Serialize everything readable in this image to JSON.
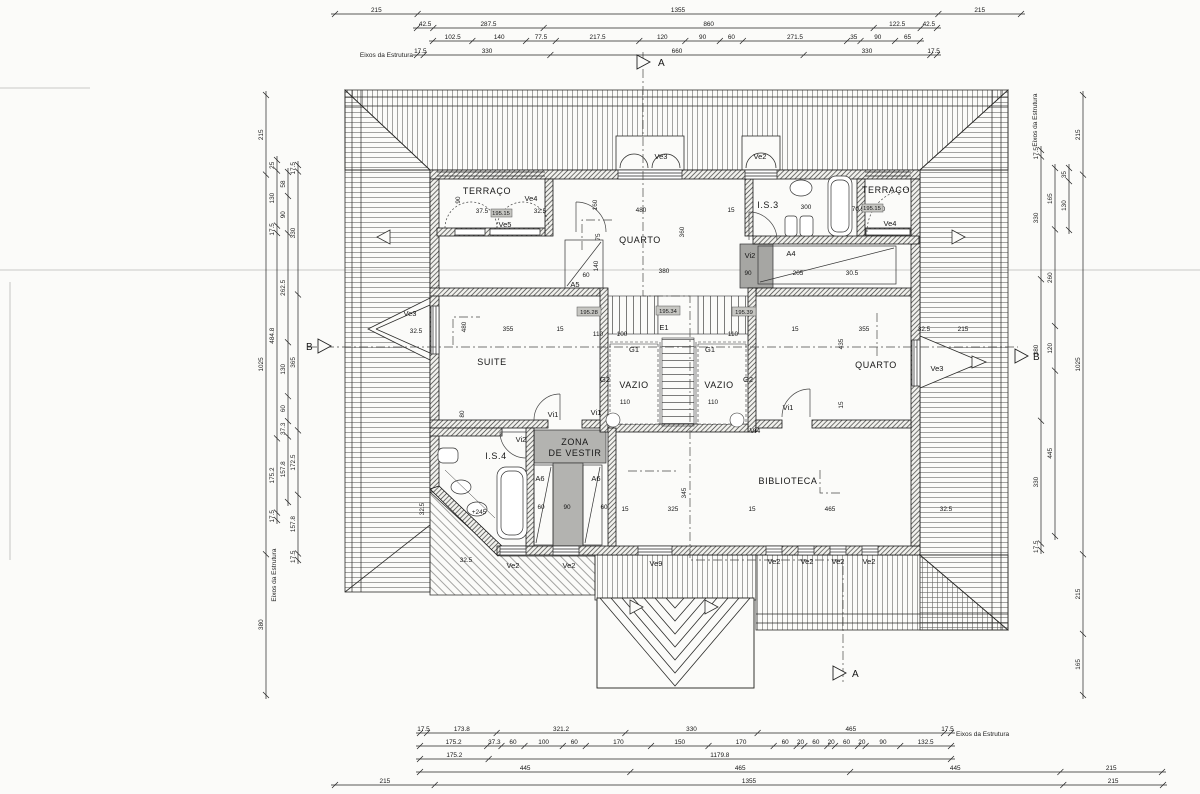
{
  "axis_label": "Eixos da Estrutura",
  "rooms": {
    "terraco_left": "TERRAÇO",
    "terraco_right": "TERRAÇO",
    "quarto_top": "QUARTO",
    "quarto_right": "QUARTO",
    "is3": "I.S.3",
    "is4": "I.S.4",
    "suite": "SUITE",
    "vazio_left": "VAZIO",
    "vazio_right": "VAZIO",
    "zona_vestir_line1": "ZONA",
    "zona_vestir_line2": "DE VESTIR",
    "biblioteca": "BIBLIOTECA"
  },
  "tags": {
    "ve2": "Ve2",
    "ve3": "Ve3",
    "ve4": "Ve4",
    "ve5": "Ve5",
    "ve9": "Ve9",
    "vi1": "Vi1",
    "vi2": "Vi2",
    "vi4": "Vi4",
    "a4": "A4",
    "a5": "A5",
    "a6": "A6",
    "e1": "E1",
    "g1": "G1",
    "g2": "G2"
  },
  "elevations": {
    "stair_left": "195.28",
    "stair_mid": "195.34",
    "stair_right": "195.39",
    "terrace_left": "195.15",
    "terrace_right": "195.15"
  },
  "sections": {
    "a": "A",
    "b": "B"
  },
  "fixture_note": "+245",
  "dim_chains": {
    "top": [
      {
        "values": [
          "215",
          "1355",
          "215"
        ]
      },
      {
        "values": [
          "42.5",
          "287.5",
          "860",
          "122.5",
          "42.5"
        ]
      },
      {
        "values": [
          "102.5",
          "140",
          "77.5",
          "217.5",
          "120",
          "90",
          "60",
          "271.5",
          "35",
          "90",
          "65"
        ]
      },
      {
        "values": [
          "17.5",
          "330",
          "660",
          "330",
          "17.5"
        ]
      }
    ],
    "bottom": [
      {
        "values": [
          "17.5",
          "173.8",
          "321.2",
          "330",
          "465",
          "17.5"
        ]
      },
      {
        "values": [
          "175.2",
          "37.3",
          "60",
          "100",
          "60",
          "170",
          "150",
          "170",
          "60",
          "20",
          "60",
          "20",
          "60",
          "20",
          "90",
          "132.5"
        ]
      },
      {
        "values": [
          "175.2",
          "1179.8"
        ]
      },
      {
        "values": [
          "445",
          "465",
          "445",
          "215"
        ]
      },
      {
        "values": [
          "215",
          "1355",
          "215"
        ]
      }
    ],
    "left": [
      {
        "values": [
          "215",
          "1025",
          "380"
        ]
      },
      {
        "values": [
          "25",
          "130",
          "17.5",
          "484.8",
          "175.2",
          "17.5"
        ]
      },
      {
        "values": [
          "58",
          "90",
          "262.5",
          "130",
          "60",
          "37.3",
          "157.8"
        ]
      },
      {
        "values": [
          "17.5",
          "330",
          "365",
          "172.5",
          "157.8",
          "17.5"
        ]
      }
    ],
    "right": [
      {
        "values": [
          "17.5",
          "330",
          "380",
          "330",
          "17.5"
        ]
      },
      {
        "values": [
          "165",
          "260",
          "120",
          "445"
        ]
      },
      {
        "values": [
          "35",
          "130"
        ]
      },
      {
        "values": [
          "215",
          "1025",
          "215",
          "165"
        ]
      }
    ]
  },
  "inline_dims": [
    {
      "v": "480",
      "x": 641,
      "y": 212
    },
    {
      "v": "15",
      "x": 731,
      "y": 212
    },
    {
      "v": "380",
      "x": 664,
      "y": 273
    },
    {
      "v": "360",
      "x": 684,
      "y": 232,
      "r": -90
    },
    {
      "v": "160",
      "x": 597,
      "y": 205,
      "r": -90
    },
    {
      "v": "75",
      "x": 600,
      "y": 237,
      "r": -90
    },
    {
      "v": "140",
      "x": 598,
      "y": 266,
      "r": -90
    },
    {
      "v": "60",
      "x": 586,
      "y": 277
    },
    {
      "v": "90",
      "x": 460,
      "y": 200,
      "r": -90
    },
    {
      "v": "37.5",
      "x": 482,
      "y": 213
    },
    {
      "v": "32.5",
      "x": 540,
      "y": 213
    },
    {
      "v": "70.5",
      "x": 858,
      "y": 211
    },
    {
      "v": "150",
      "x": 880,
      "y": 211
    },
    {
      "v": "300",
      "x": 806,
      "y": 209
    },
    {
      "v": "90",
      "x": 748,
      "y": 275
    },
    {
      "v": "205",
      "x": 798,
      "y": 275
    },
    {
      "v": "30.5",
      "x": 852,
      "y": 275
    },
    {
      "v": "355",
      "x": 508,
      "y": 331
    },
    {
      "v": "15",
      "x": 560,
      "y": 331
    },
    {
      "v": "480",
      "x": 466,
      "y": 327,
      "r": -90
    },
    {
      "v": "32.5",
      "x": 416,
      "y": 333
    },
    {
      "v": "80",
      "x": 464,
      "y": 414,
      "r": -90
    },
    {
      "v": "110",
      "x": 598,
      "y": 336
    },
    {
      "v": "100",
      "x": 622,
      "y": 336
    },
    {
      "v": "110",
      "x": 733,
      "y": 336
    },
    {
      "v": "110",
      "x": 625,
      "y": 404
    },
    {
      "v": "110",
      "x": 713,
      "y": 404
    },
    {
      "v": "15",
      "x": 795,
      "y": 331
    },
    {
      "v": "355",
      "x": 864,
      "y": 331
    },
    {
      "v": "32.5",
      "x": 924,
      "y": 331
    },
    {
      "v": "215",
      "x": 963,
      "y": 331
    },
    {
      "v": "435",
      "x": 843,
      "y": 344,
      "r": -90
    },
    {
      "v": "15",
      "x": 843,
      "y": 405,
      "r": -90
    },
    {
      "v": "345",
      "x": 686,
      "y": 493,
      "r": -90
    },
    {
      "v": "15",
      "x": 625,
      "y": 511
    },
    {
      "v": "325",
      "x": 673,
      "y": 511
    },
    {
      "v": "15",
      "x": 752,
      "y": 511
    },
    {
      "v": "465",
      "x": 830,
      "y": 511
    },
    {
      "v": "32.5",
      "x": 946,
      "y": 511
    },
    {
      "v": "60",
      "x": 541,
      "y": 509
    },
    {
      "v": "90",
      "x": 567,
      "y": 509
    },
    {
      "v": "60",
      "x": 604,
      "y": 509
    },
    {
      "v": "32.5",
      "x": 424,
      "y": 509,
      "r": -90
    },
    {
      "v": "32.5",
      "x": 466,
      "y": 562
    }
  ]
}
